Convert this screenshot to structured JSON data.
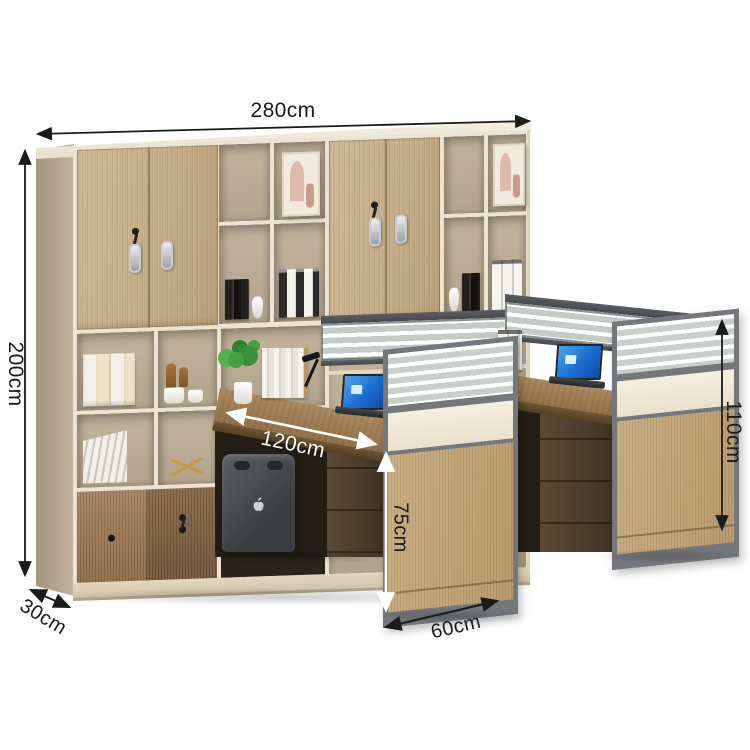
{
  "annotations": {
    "overall_width": "280cm",
    "overall_height": "200cm",
    "cabinet_depth": "30cm",
    "desk_length": "120cm",
    "desk_height": "75cm",
    "desk_depth": "60cm",
    "screen_height": "110cm"
  },
  "icons": {
    "computer_tower_logo": "apple-logo",
    "cabinet_hardware": "u-shaped-handle",
    "lock": "key-in-lock",
    "sliding_door_hardware": "round-knob"
  },
  "colors": {
    "frame_cream": "#ece4d1",
    "wood_light": "#c9b28e",
    "wood_mid": "#9b7c5a",
    "wood_dark": "#7e6147",
    "interior_beige": "#b9aa92",
    "desk_wood": "#9e7d53",
    "pedestal_brown": "#473929",
    "partition_gray": "#74787c",
    "partition_wood": "#c2a477",
    "panel_cream": "#f1ead8",
    "laptop_screen_blue": "#1b6cd2",
    "plant_green": "#45a043",
    "gold_accent": "#c49a3f",
    "dimension_line_black": "#1b1b1b",
    "dimension_line_white": "#ffffff"
  }
}
